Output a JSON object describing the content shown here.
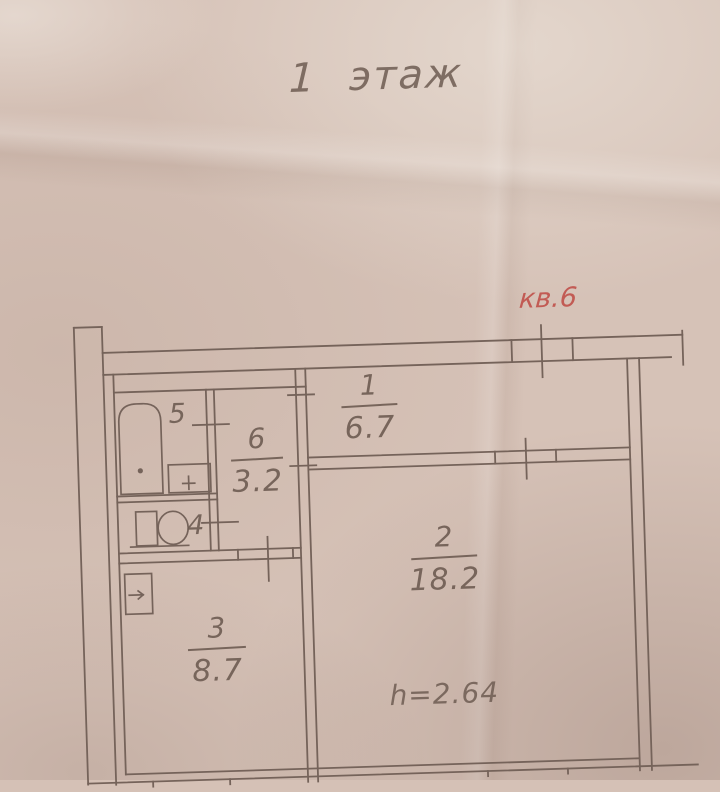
{
  "document": {
    "floor_title": "1 этаж",
    "apartment_label": "кв.6",
    "ceiling_height": "h=2.64"
  },
  "rooms": {
    "room1": {
      "number": "1",
      "area": "6.7"
    },
    "room2": {
      "number": "2",
      "area": "18.2"
    },
    "room3": {
      "number": "3",
      "area": "8.7"
    },
    "room6": {
      "number": "6",
      "area": "3.2"
    },
    "room5": {
      "number": "5"
    },
    "room4": {
      "number": "4"
    }
  },
  "fixtures": {
    "bathtub_icon": "bathtub",
    "sink_icon": "sink",
    "toilet_icon": "toilet",
    "vent_icon": "vent-duct-arrow"
  },
  "colors": {
    "paper": "#d6c2b7",
    "ink": "#6e5c52",
    "line": "#75635a",
    "red_label": "#c0504a"
  }
}
